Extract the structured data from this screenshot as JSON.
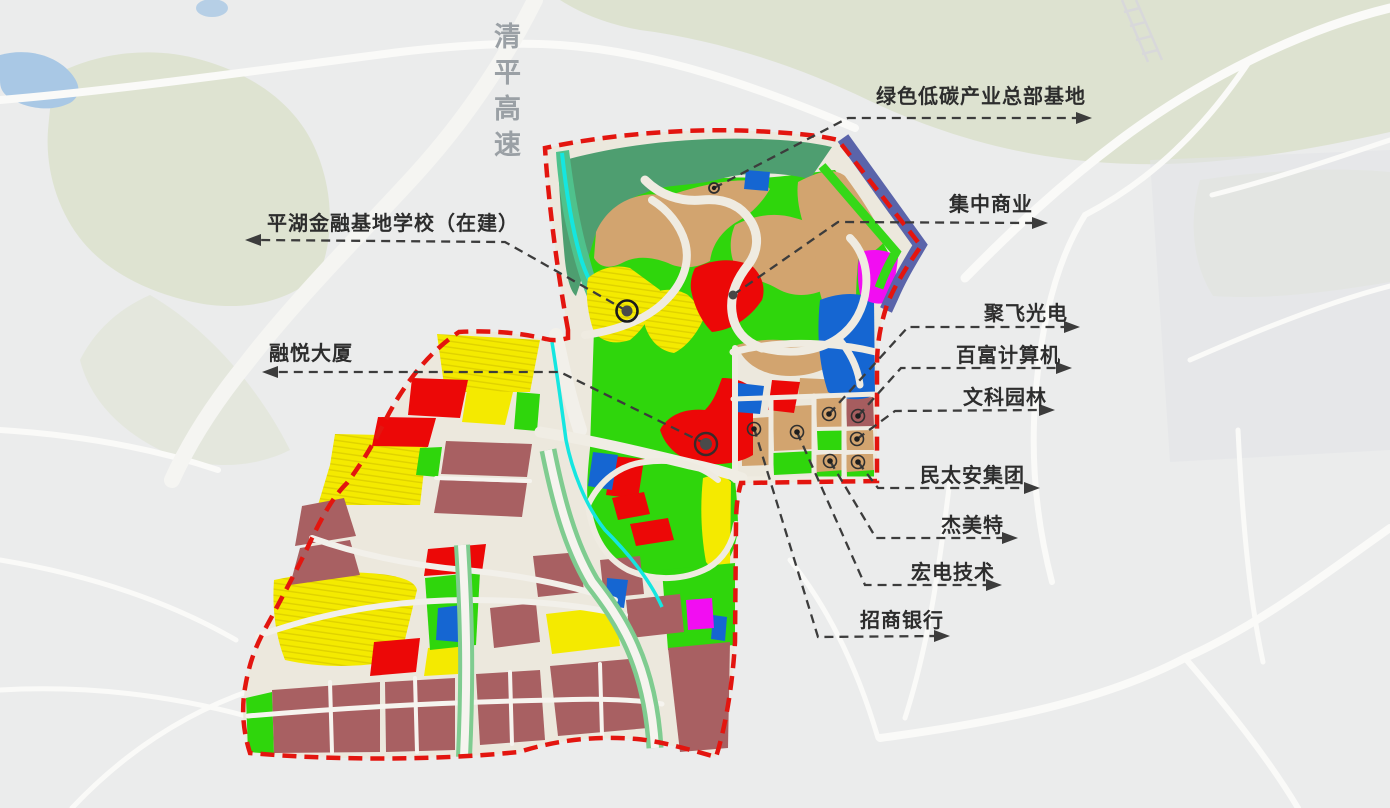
{
  "map": {
    "expressway_label": "清平高速",
    "callouts": [
      {
        "id": "green-lowcarbon-base",
        "text": "绿色低碳产业总部基地",
        "direction": "right"
      },
      {
        "id": "pinghu-finance-school",
        "text": "平湖金融基地学校（在建）",
        "direction": "left"
      },
      {
        "id": "central-commerce",
        "text": "集中商业",
        "direction": "right"
      },
      {
        "id": "jufei-optoelectronics",
        "text": "聚飞光电",
        "direction": "right"
      },
      {
        "id": "pax-computer",
        "text": "百富计算机",
        "direction": "right"
      },
      {
        "id": "wenke-landscape",
        "text": "文科园林",
        "direction": "right"
      },
      {
        "id": "rongyue-tower",
        "text": "融悦大厦",
        "direction": "left"
      },
      {
        "id": "mintaian-group",
        "text": "民太安集团",
        "direction": "right"
      },
      {
        "id": "jiemeite",
        "text": "杰美特",
        "direction": "right"
      },
      {
        "id": "hongdian-tech",
        "text": "宏电技术",
        "direction": "right"
      },
      {
        "id": "cmb-bank",
        "text": "招商银行",
        "direction": "right"
      }
    ],
    "colors": {
      "boundary_red": "#E3150F",
      "parcel_yellow": "#F4EA00",
      "parcel_green": "#2FD60C",
      "parcel_seagreen": "#4E9E70",
      "parcel_tan": "#D2A46F",
      "parcel_red": "#EC0807",
      "parcel_maroon": "#A86062",
      "parcel_blue": "#1566D2",
      "parcel_magenta": "#F20DF2",
      "band_slate": "#5A64AA",
      "stream_cyan": "#15E6E0",
      "leader_dark": "#3C3C3C",
      "expressway_gray": "#9AA0A5"
    }
  }
}
